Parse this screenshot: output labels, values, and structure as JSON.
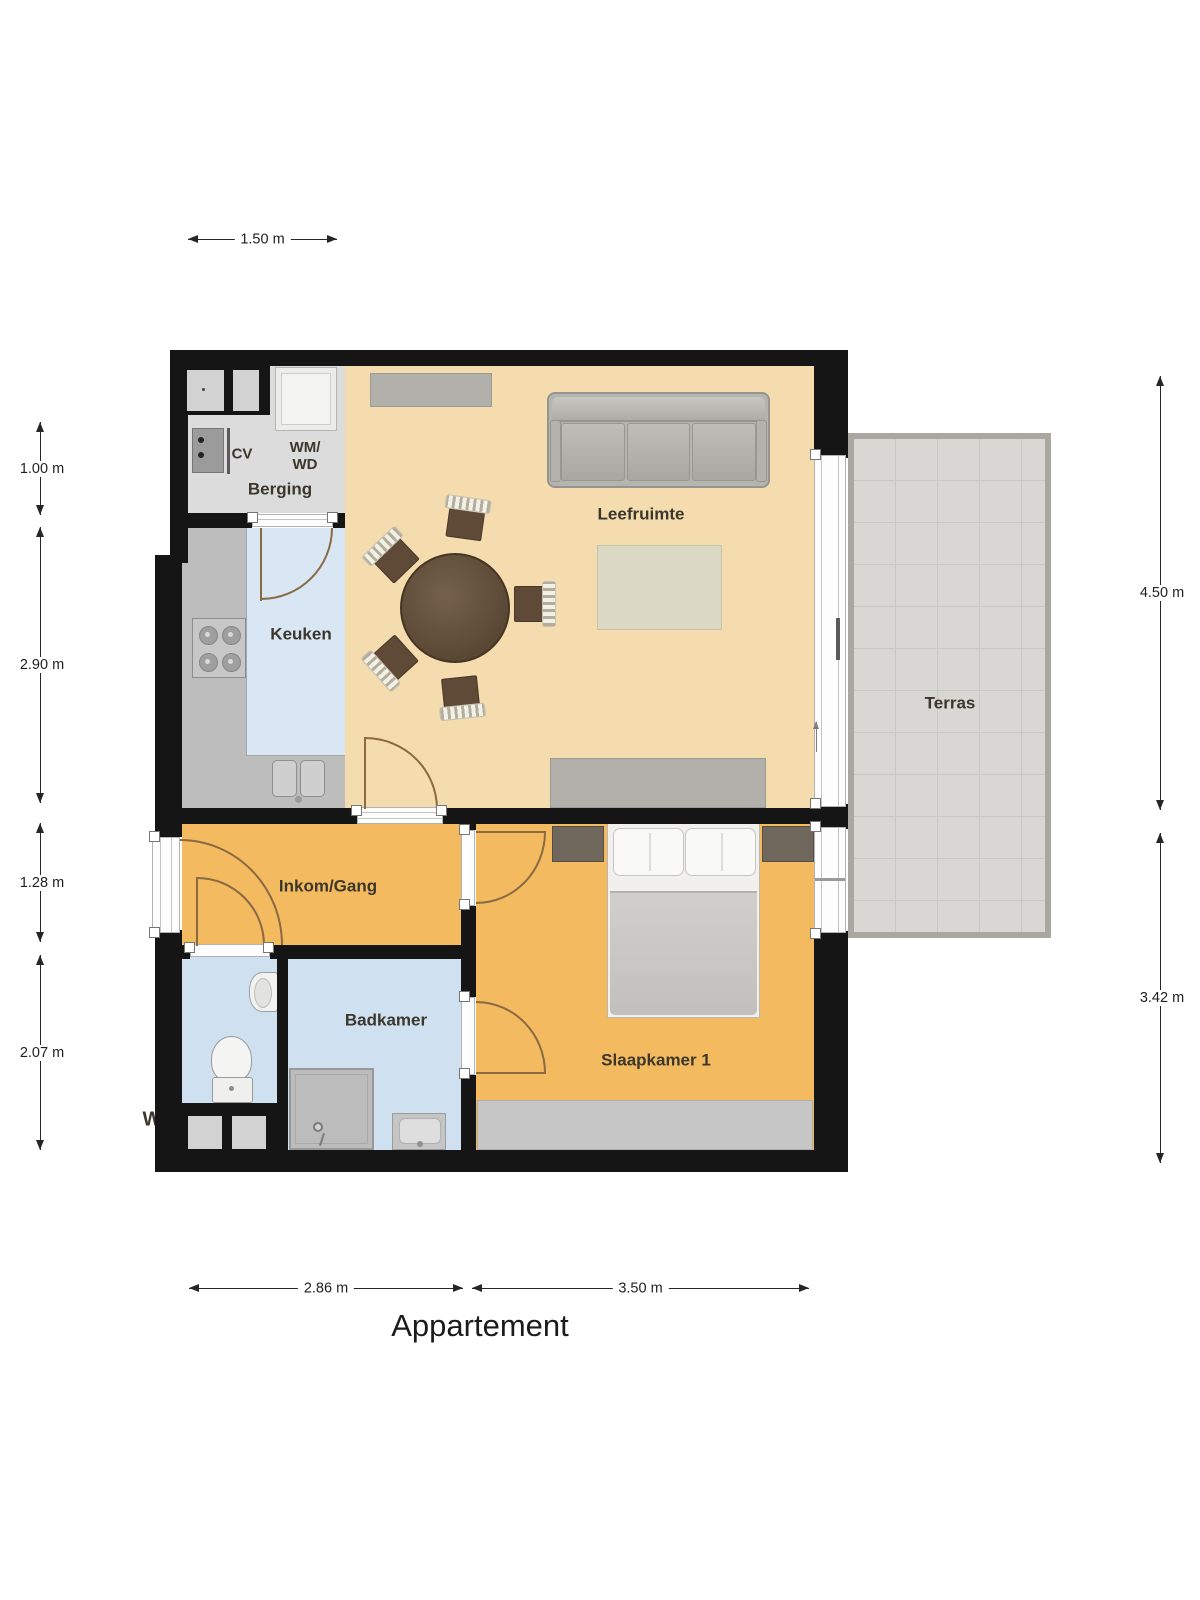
{
  "title": "Appartement",
  "rooms": {
    "berging": "Berging",
    "cv": "CV",
    "wm": "WM/",
    "wd": "WD",
    "keuken": "Keuken",
    "leefruimte": "Leefruimte",
    "inkom_gang": "Inkom/Gang",
    "badkamer": "Badkamer",
    "slaapkamer": "Slaapkamer 1",
    "terras": "Terras",
    "wc_partial": "W"
  },
  "dimensions": {
    "top": "1.50 m",
    "left": [
      "1.00 m",
      "2.90 m",
      "1.28 m",
      "2.07 m"
    ],
    "right": [
      "4.50 m",
      "3.42 m"
    ],
    "bottom": [
      "2.86 m",
      "3.50 m"
    ]
  },
  "colors": {
    "wall": "#151515",
    "living_floor": "#f4dcae",
    "hall_floor": "#f3ba5f",
    "kitchen_floor": "#d9e7f4",
    "bath_floor": "#cfe0f1",
    "storage_floor": "#dcdcdc",
    "terrace_floor": "#d8d7d3",
    "counter": "#bdbdbd",
    "door_arc": "#8a6a43"
  }
}
